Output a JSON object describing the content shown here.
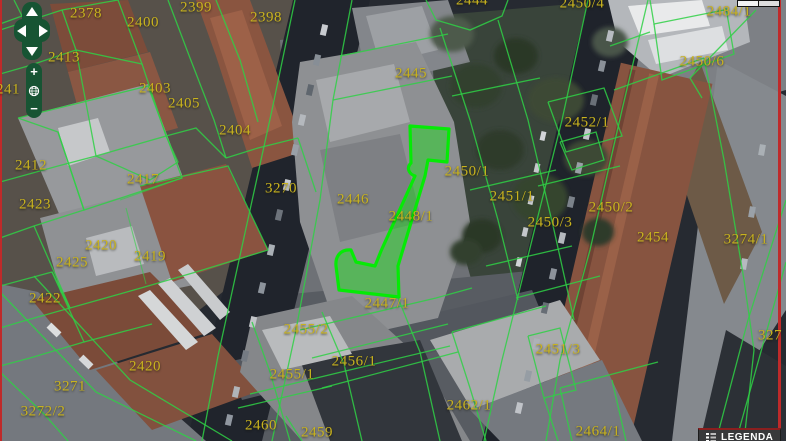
{
  "map": {
    "selected_parcel": "2448/1",
    "labels": [
      {
        "text": "2378",
        "x": 86,
        "y": 14
      },
      {
        "text": "2399",
        "x": 196,
        "y": 8
      },
      {
        "text": "2400",
        "x": 143,
        "y": 23
      },
      {
        "text": "2398",
        "x": 266,
        "y": 18
      },
      {
        "text": "2444",
        "x": 472,
        "y": 1
      },
      {
        "text": "2450/4",
        "x": 582,
        "y": 4
      },
      {
        "text": "2484/1",
        "x": 729,
        "y": 12
      },
      {
        "text": "2413",
        "x": 64,
        "y": 58
      },
      {
        "text": "2450/6",
        "x": 702,
        "y": 62
      },
      {
        "text": "241",
        "x": 8,
        "y": 90
      },
      {
        "text": "2403",
        "x": 155,
        "y": 89
      },
      {
        "text": "2405",
        "x": 184,
        "y": 104
      },
      {
        "text": "2445",
        "x": 411,
        "y": 74
      },
      {
        "text": "2404",
        "x": 235,
        "y": 131
      },
      {
        "text": "2452/1",
        "x": 587,
        "y": 123
      },
      {
        "text": "2412",
        "x": 31,
        "y": 166
      },
      {
        "text": "2417",
        "x": 143,
        "y": 180
      },
      {
        "text": "2450/1",
        "x": 467,
        "y": 172
      },
      {
        "text": "3270",
        "x": 281,
        "y": 189
      },
      {
        "text": "2451/1",
        "x": 512,
        "y": 197
      },
      {
        "text": "2446",
        "x": 353,
        "y": 200
      },
      {
        "text": "2423",
        "x": 35,
        "y": 205
      },
      {
        "text": "2450/2",
        "x": 611,
        "y": 208
      },
      {
        "text": "2448/1",
        "x": 411,
        "y": 217
      },
      {
        "text": "2450/3",
        "x": 550,
        "y": 223
      },
      {
        "text": "2454",
        "x": 653,
        "y": 238
      },
      {
        "text": "3274/1",
        "x": 746,
        "y": 240
      },
      {
        "text": "2420",
        "x": 101,
        "y": 246
      },
      {
        "text": "2419",
        "x": 150,
        "y": 257
      },
      {
        "text": "2425",
        "x": 72,
        "y": 263
      },
      {
        "text": "2422",
        "x": 45,
        "y": 299
      },
      {
        "text": "2447/1",
        "x": 387,
        "y": 304
      },
      {
        "text": "2455/2",
        "x": 306,
        "y": 330
      },
      {
        "text": "2451/3",
        "x": 558,
        "y": 350
      },
      {
        "text": "2456/1",
        "x": 354,
        "y": 362
      },
      {
        "text": "2420",
        "x": 145,
        "y": 367
      },
      {
        "text": "2455/1",
        "x": 292,
        "y": 375
      },
      {
        "text": "3271",
        "x": 70,
        "y": 387
      },
      {
        "text": "2462/1",
        "x": 469,
        "y": 406
      },
      {
        "text": "3272/2",
        "x": 43,
        "y": 412
      },
      {
        "text": "2460",
        "x": 261,
        "y": 426
      },
      {
        "text": "2459",
        "x": 317,
        "y": 433
      },
      {
        "text": "2464/1",
        "x": 598,
        "y": 432
      },
      {
        "text": "327",
        "x": 770,
        "y": 336
      }
    ]
  },
  "controls": {
    "zoom_in": "+",
    "zoom_out": "−"
  },
  "legend": {
    "label": "LEGENDA"
  },
  "colors": {
    "parcel_line": "#2fd045",
    "highlight": "#00ee00",
    "label": "#c9b31e",
    "control_green": "#175433",
    "edge_red": "#bf2a2a"
  }
}
